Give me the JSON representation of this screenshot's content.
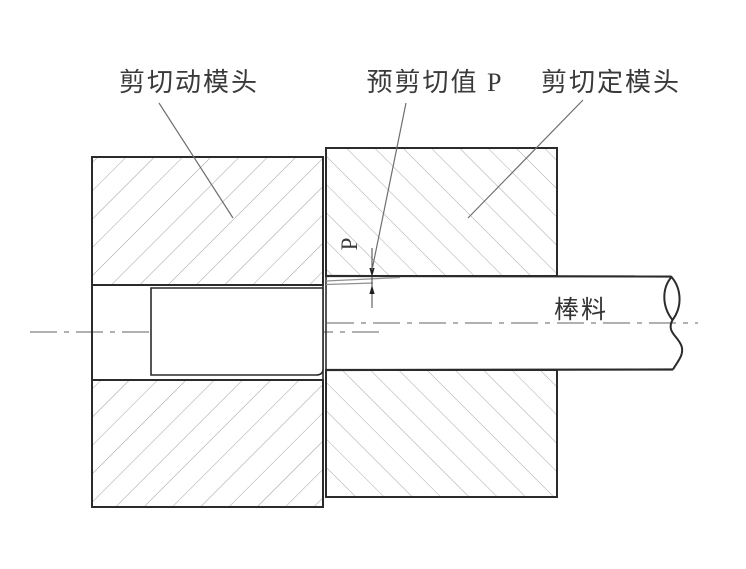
{
  "figure": {
    "type": "engineering-section-diagram",
    "labels": {
      "moving_die": "剪切动模头",
      "preshear_value": "预剪切值 P",
      "fixed_die": "剪切定模头",
      "bar_stock": "棒料",
      "dimension_p": "P"
    },
    "colors": {
      "background": "#ffffff",
      "outline": "#2b2b2b",
      "hatch_left": "#a0a0a0",
      "hatch_right": "#a8a8a8",
      "centerline": "#808080",
      "leader_line": "#6e6e6e",
      "shear_taper": "#909090",
      "text": "#3a3a3a"
    }
  }
}
